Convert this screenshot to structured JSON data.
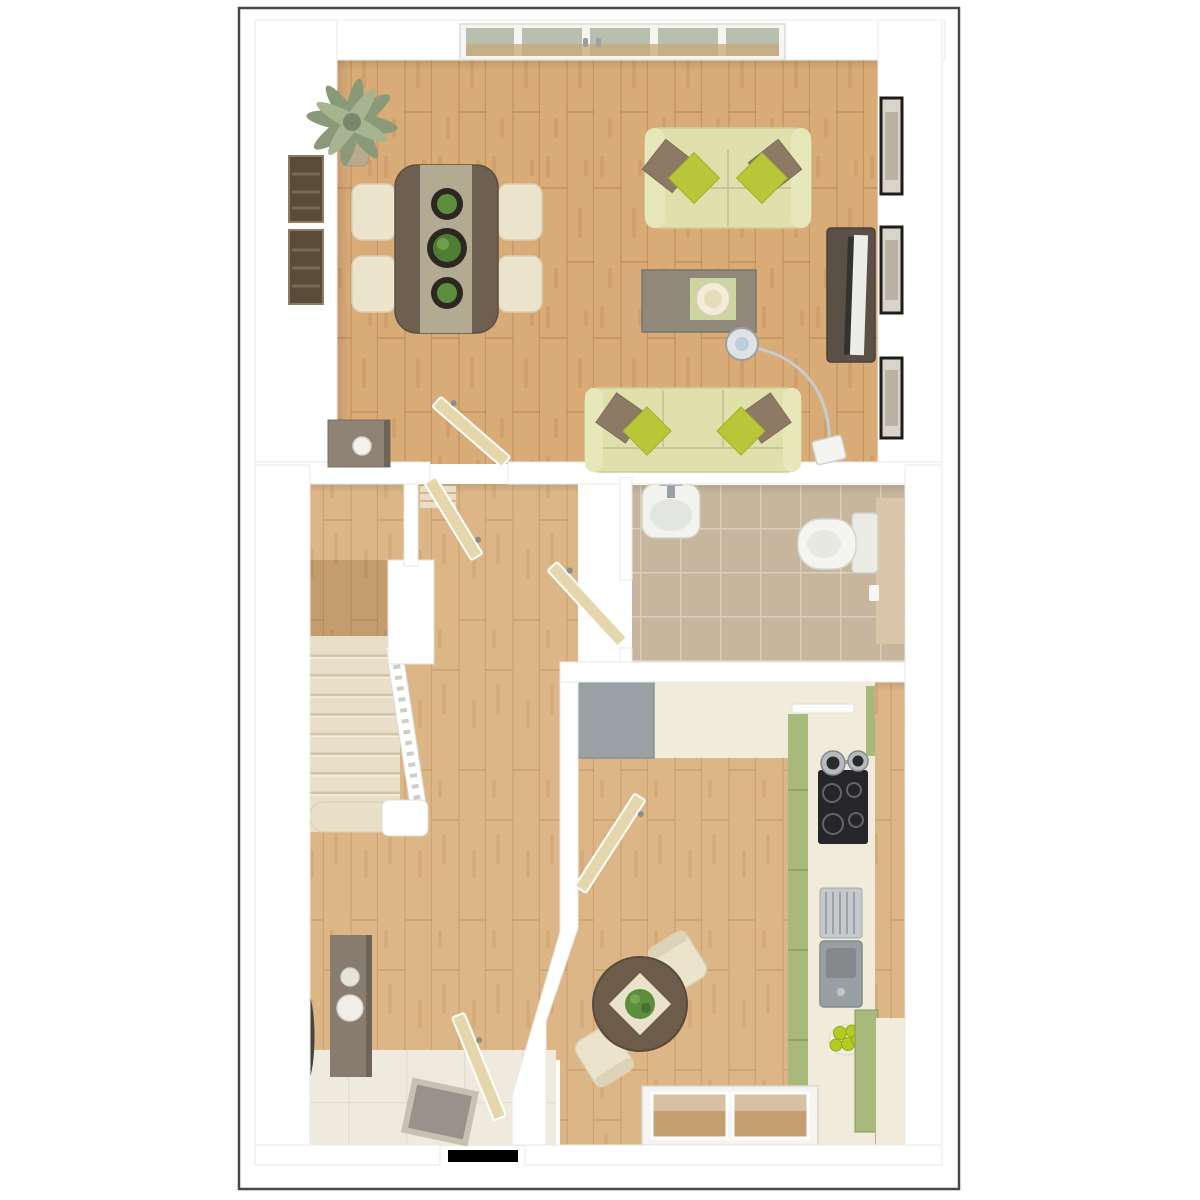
{
  "scene": {
    "kind": "3d-top-down-floor-plan-render",
    "rooms": [
      "living-dining-room",
      "hallway-with-stairs",
      "cloakroom-bathroom",
      "kitchen-breakfast",
      "entrance-hall"
    ],
    "icons": [
      "palm-plant-icon",
      "sofa-icon",
      "dining-table-icon",
      "coffee-table-icon",
      "tv-icon",
      "arc-lamp-icon",
      "picture-frame-icon",
      "stairs-icon",
      "toilet-icon",
      "washbasin-icon",
      "hob-icon",
      "sink-icon",
      "fruit-bowl-icon",
      "mirror-icon",
      "door-leaf-icon",
      "window-icon",
      "doormat-icon"
    ]
  },
  "colors": {
    "page_bg": "#ffffff",
    "frame_border": "#474747",
    "wall": "#ffffff",
    "wall_edge": "#e4e2de",
    "wood_floor": "#d8ab77",
    "wood_floor_light": "#ddb687",
    "carpet": "#e9dfc9",
    "carpet_shadow": "#d2c5a6",
    "carpet_light": "#f5eedd",
    "bath_tile": "#c7b69d",
    "bath_grout": "#dbcfb9",
    "bath_panel": "#d9c6a8",
    "entry_tile": "#eeeade",
    "doormat": "#98928a",
    "sofa": "#dfe0ab",
    "sofa_arm": "#e7e8ba",
    "sofa_line": "#c6c79c",
    "pillow_lime": "#b9c637",
    "pillow_brown": "#8c7a65",
    "dining_table": "#6e6051",
    "table_runner": "#b3aa94",
    "chair_cream": "#ebe3cb",
    "coffee_table": "#8f887b",
    "tray_mat": "#cdd5a0",
    "tray": "#f2ecd8",
    "tv_unit": "#5b5046",
    "tv_screen": "#ececea",
    "picture_frame": "#1f1d1b",
    "picture_inner": "#b9b2a5",
    "wood_art": "#5a4a38",
    "plant_sage": "#8a9a78",
    "plant_green": "#5d8e3e",
    "bowl_dark": "#2c2821",
    "glass": "#b9bfae",
    "glass_reflection": "#c8a877",
    "door_leaf": "#e5d7ab",
    "cabinet_taupe": "#877c6f",
    "mirror_frame": "#45443f",
    "mirror_glass": "#d8d8d3",
    "worktop_cream": "#f1ebdb",
    "counter_gray": "#9aa1a5",
    "kitchen_green": "#a9b87b",
    "hob_black": "#26262a",
    "steel": "#b7bbbe",
    "sink_gray": "#99a0a3",
    "apple_green": "#b4cc21",
    "kitchen_table": "#6d5c4a",
    "mat_cream": "#eae2ca",
    "lamp_chrome": "#c6ccd0",
    "side_table": "#8f8376"
  }
}
